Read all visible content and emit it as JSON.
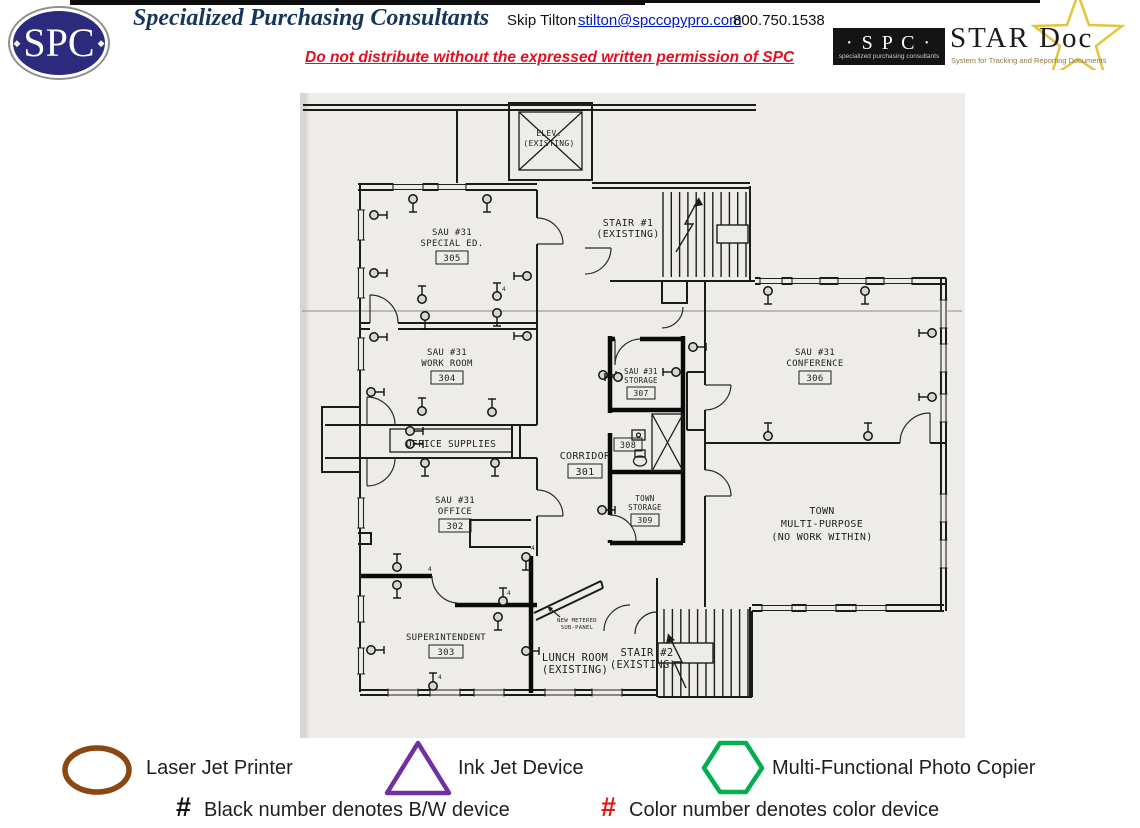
{
  "header": {
    "logo_text": "SPC",
    "logo_diamond": "◆",
    "company": "Specialized Purchasing Consultants",
    "contact_name": "Skip Tilton",
    "email": "stilton@spccopypro.com",
    "phone": "800.750.1538",
    "notice": "Do not distribute without the expressed written permission of SPC",
    "stardoc": {
      "spc_text": "· S P C ·",
      "spc_sub": "specialized purchasing consultants",
      "title": "STAR Doc",
      "tagline": "System for Tracking and Reporting Documents",
      "star_color": "#e2c43e"
    }
  },
  "plan": {
    "labels": {
      "elev1": "ELEV.",
      "elev2": "(EXISTING)",
      "stair1a": "STAIR #1",
      "stair1b": "(EXISTING)",
      "r305a": "SAU #31",
      "r305b": "SPECIAL ED.",
      "r305n": "305",
      "r304a": "SAU #31",
      "r304b": "WORK ROOM",
      "r304n": "304",
      "supplies": "OFFICE SUPPLIES",
      "corr": "CORRIDOR",
      "corrn": "301",
      "r307a": "SAU #31",
      "r307b": "STORAGE",
      "r307n": "307",
      "r308n": "308",
      "r309a": "TOWN",
      "r309b": "STORAGE",
      "r309n": "309",
      "r302a": "SAU #31",
      "r302b": "OFFICE",
      "r302n": "302",
      "r303a": "SUPERINTENDENT",
      "r303n": "303",
      "lunch1": "LUNCH ROOM",
      "lunch2": "(EXISTING)",
      "stair2a": "STAIR #2",
      "stair2b": "(EXISTING)",
      "r306a": "SAU #31",
      "r306b": "CONFERENCE",
      "r306n": "306",
      "multi1": "TOWN",
      "multi2": "MULTI-PURPOSE",
      "multi3": "(NO WORK WITHIN)",
      "panel1": "NEW METERED",
      "panel2": "SUB-PANEL"
    },
    "circuit_mark": "4",
    "circuit_labels": [
      {
        "x": 504,
        "y": 291
      },
      {
        "x": 533,
        "y": 550
      },
      {
        "x": 440,
        "y": 679
      },
      {
        "x": 430,
        "y": 571
      },
      {
        "x": 509,
        "y": 595
      }
    ],
    "devices": [
      {
        "x": 413,
        "y": 199,
        "d": "s"
      },
      {
        "x": 487,
        "y": 199,
        "d": "s"
      },
      {
        "x": 374,
        "y": 215,
        "d": "e"
      },
      {
        "x": 374,
        "y": 273,
        "d": "e"
      },
      {
        "x": 374,
        "y": 337,
        "d": "e"
      },
      {
        "x": 371,
        "y": 392,
        "d": "e"
      },
      {
        "x": 527,
        "y": 276,
        "d": "w"
      },
      {
        "x": 422,
        "y": 299,
        "d": "n"
      },
      {
        "x": 497,
        "y": 296,
        "d": "n"
      },
      {
        "x": 425,
        "y": 316,
        "d": "s"
      },
      {
        "x": 497,
        "y": 313,
        "d": "s"
      },
      {
        "x": 527,
        "y": 336,
        "d": "w"
      },
      {
        "x": 422,
        "y": 411,
        "d": "n"
      },
      {
        "x": 492,
        "y": 412,
        "d": "n"
      },
      {
        "x": 410,
        "y": 431,
        "d": "e"
      },
      {
        "x": 410,
        "y": 444,
        "d": "e"
      },
      {
        "x": 425,
        "y": 463,
        "d": "s"
      },
      {
        "x": 495,
        "y": 463,
        "d": "s"
      },
      {
        "x": 603,
        "y": 375,
        "d": "e"
      },
      {
        "x": 618,
        "y": 377,
        "d": "w"
      },
      {
        "x": 676,
        "y": 372,
        "d": "w"
      },
      {
        "x": 693,
        "y": 347,
        "d": "e"
      },
      {
        "x": 768,
        "y": 291,
        "d": "s"
      },
      {
        "x": 865,
        "y": 291,
        "d": "s"
      },
      {
        "x": 932,
        "y": 333,
        "d": "w"
      },
      {
        "x": 932,
        "y": 397,
        "d": "w"
      },
      {
        "x": 768,
        "y": 436,
        "d": "n"
      },
      {
        "x": 868,
        "y": 436,
        "d": "n"
      },
      {
        "x": 602,
        "y": 510,
        "d": "e"
      },
      {
        "x": 526,
        "y": 557,
        "d": "s"
      },
      {
        "x": 397,
        "y": 567,
        "d": "n"
      },
      {
        "x": 397,
        "y": 585,
        "d": "s"
      },
      {
        "x": 503,
        "y": 601,
        "d": "n"
      },
      {
        "x": 498,
        "y": 617,
        "d": "s"
      },
      {
        "x": 526,
        "y": 651,
        "d": "e"
      },
      {
        "x": 371,
        "y": 650,
        "d": "e"
      },
      {
        "x": 433,
        "y": 686,
        "d": "n"
      }
    ]
  },
  "legend": {
    "items": [
      {
        "label": "Laser Jet Printer",
        "shape": "ellipse",
        "color": "#8a4712"
      },
      {
        "label": "Ink Jet Device",
        "shape": "triangle",
        "color": "#7030a0"
      },
      {
        "label": "Multi-Functional Photo Copier",
        "shape": "hexagon",
        "color": "#00b050"
      }
    ],
    "bw_hash": "#",
    "bw_note": "Black number denotes B/W device",
    "color_hash": "#",
    "color_note": "Color number denotes color device",
    "hash_black": "#111111",
    "hash_red": "#e81313"
  }
}
